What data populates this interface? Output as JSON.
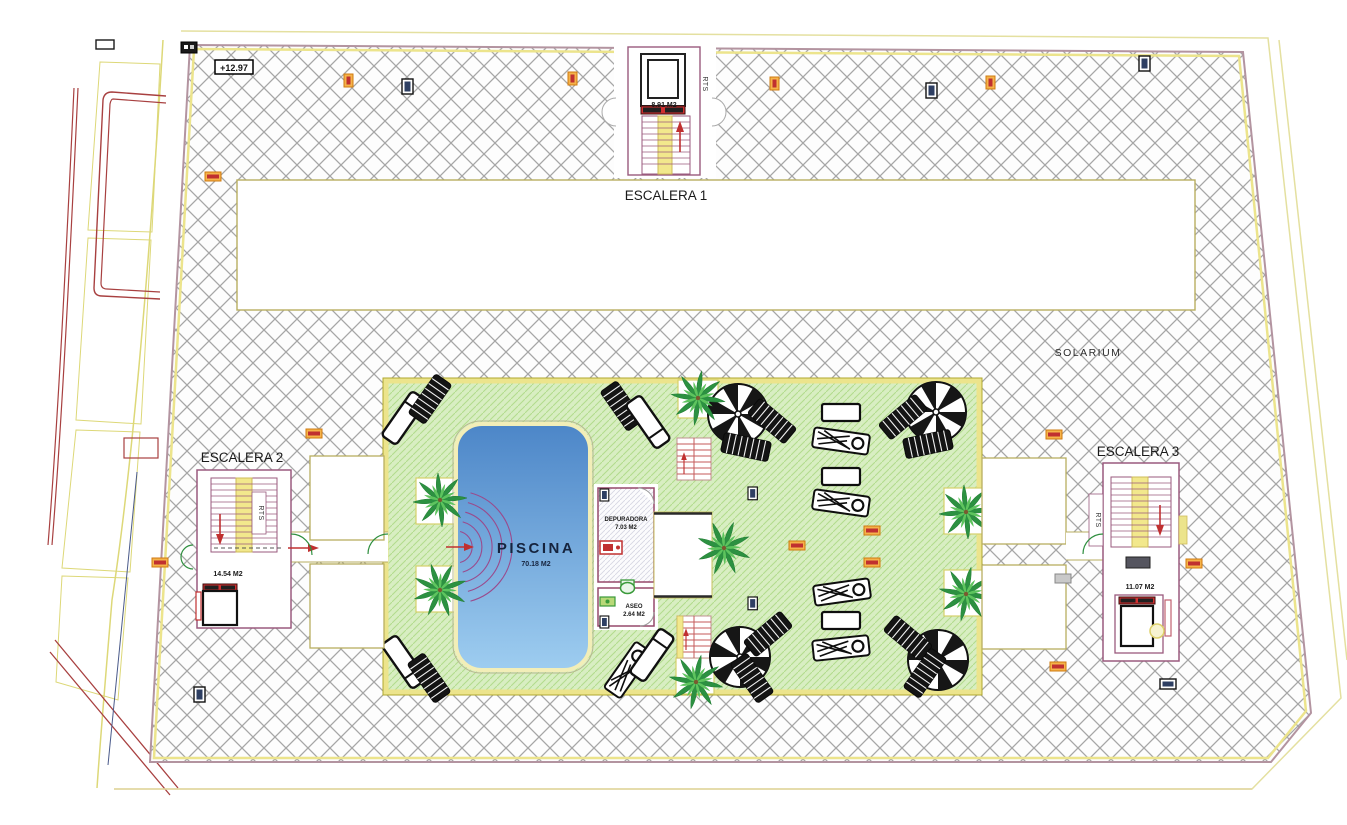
{
  "plan": {
    "solarium_label": "SOLARIUM",
    "level_marker": "+12.97",
    "rooms": {
      "escalera1": {
        "title": "ESCALERA 1",
        "area": "8.91 M2",
        "rts": "RTS"
      },
      "escalera2": {
        "title": "ESCALERA 2",
        "area": "14.54 M2",
        "rts": "RTS"
      },
      "escalera3": {
        "title": "ESCALERA 3",
        "area": "11.07 M2",
        "rts": "RTS"
      },
      "piscina": {
        "title": "PISCINA",
        "area": "70.18 M2"
      },
      "depuradora": {
        "title": "DEPURADORA",
        "area": "7.03 M2"
      },
      "aseo": {
        "title": "ASEO",
        "area": "2.64 M2"
      }
    },
    "colors": {
      "pool_top": "#4c86c8",
      "pool_bottom": "#9ecdf0",
      "deck_green": "#d8eec2",
      "deck_hatch_line": "#b2dc8c",
      "solarium_hatch_line": "#a6a6a6",
      "border_yellow": "#ece48c",
      "wall_purple": "#9a5a7e",
      "accent_red": "#c03030",
      "accent_orange": "#f0a030",
      "marker_blue": "#2e3f63"
    }
  }
}
